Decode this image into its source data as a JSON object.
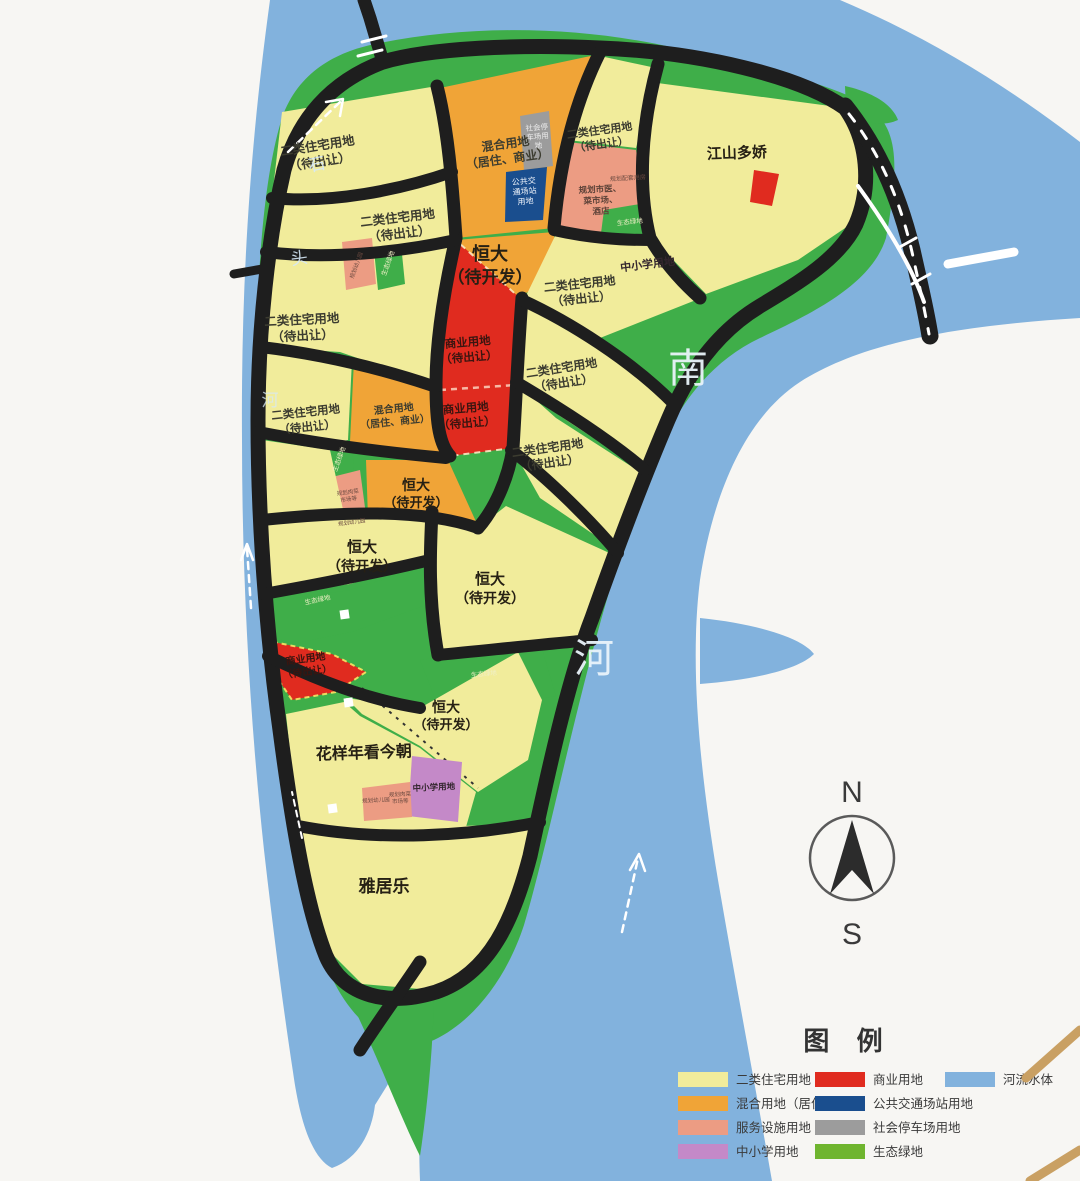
{
  "colors": {
    "river": "#82B2DD",
    "green": "#3FAE49",
    "greenBright": "#6FB52F",
    "yellow": "#F1EC9B",
    "orange": "#F0A437",
    "salmon": "#EC9C83",
    "purple": "#C489C8",
    "red": "#E02B1F",
    "blue": "#1A4E8E",
    "gray": "#9C9C9C",
    "road": "#1E1E1E",
    "tan": "#C9A063",
    "white": "#FFFFFF"
  },
  "t": {
    "res1": "二类住宅用地",
    "res2": "（待出让）",
    "mix1": "混合用地",
    "mix2": "（居住、商业）",
    "hd1": "恒大",
    "hd2": "（待开发）",
    "com1": "商业用地",
    "com2": "（待出让）",
    "js": "江山多娇",
    "hy": "花样年看今朝",
    "yjl": "雅居乐",
    "school": "中小学用地",
    "tr1": "公共交",
    "tr2": "通场站",
    "tr3": "用地",
    "pk1": "社会停",
    "pk2": "车场用",
    "pk3": "地",
    "sv1": "规划市医、",
    "sv2": "菜市场、",
    "sv3": "酒店",
    "eco": "生态绿地",
    "n1": "规划配套用房",
    "n2": "规划幼儿园",
    "n3": "规划肉菜",
    "n4": "市场等",
    "n5": "规划幼儿园",
    "n6": "规划幼儿园",
    "n7": "规划肉菜",
    "n8": "市场等"
  },
  "water": {
    "south": "南",
    "river": "河",
    "left1": "石",
    "left2": "头",
    "left3": "河"
  },
  "compass": {
    "north": "N",
    "south": "S"
  },
  "legend": {
    "title": "图  例",
    "items": [
      {
        "label": "二类住宅用地",
        "color": "yellow"
      },
      {
        "label": "混合用地（居住、商业）",
        "color": "orange"
      },
      {
        "label": "服务设施用地",
        "color": "salmon"
      },
      {
        "label": "中小学用地",
        "color": "purple"
      },
      {
        "label": "商业用地",
        "color": "red"
      },
      {
        "label": "公共交通场站用地",
        "color": "blue"
      },
      {
        "label": "社会停车场用地",
        "color": "gray"
      },
      {
        "label": "生态绿地",
        "color": "greenBright"
      },
      {
        "label": "河流水体",
        "color": "river"
      }
    ]
  }
}
